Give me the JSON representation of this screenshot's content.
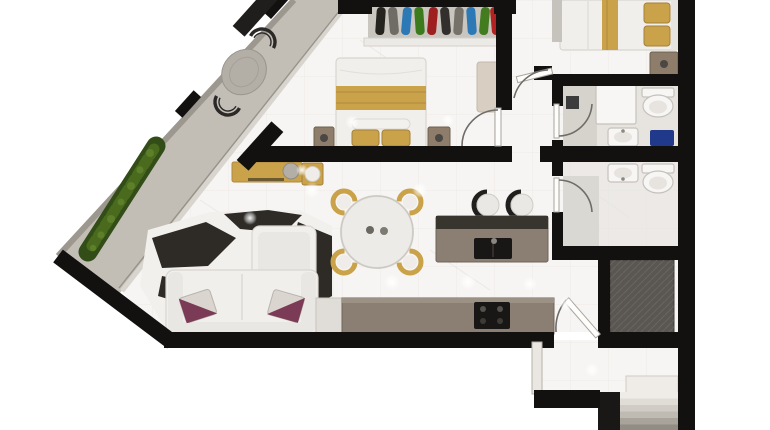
{
  "scene": {
    "type": "3d-rendered-apartment-floor-plan-top-view",
    "rooms": [
      {
        "name": "balcony-terrace"
      },
      {
        "name": "master-bedroom"
      },
      {
        "name": "second-bedroom"
      },
      {
        "name": "bathroom-top"
      },
      {
        "name": "bathroom-bottom"
      },
      {
        "name": "hallway"
      },
      {
        "name": "living-room"
      },
      {
        "name": "dining-area"
      },
      {
        "name": "kitchen"
      },
      {
        "name": "entry-vestibule"
      },
      {
        "name": "stair-lobby"
      },
      {
        "name": "elevator-shaft"
      }
    ],
    "furniture_icons": [
      "balcony-round-table-icon",
      "balcony-wire-chair-icon",
      "planter-hedge-icon",
      "open-wardrobe-icon",
      "double-bed-icon",
      "nightstand-icon",
      "bedroom-bench-icon",
      "gold-console-icon",
      "round-wall-mirror-icon",
      "dining-table-icon",
      "gold-dining-chair-icon",
      "kitchen-island-icon",
      "bar-stool-icon",
      "kitchen-counter-icon",
      "cooktop-icon",
      "fridge-icon",
      "l-shaped-sofa-icon",
      "cowhide-rug-icon",
      "throw-pillow-icon",
      "toilet-icon",
      "sink-icon",
      "shower-drain-icon",
      "blue-mat-icon",
      "stairs-icon"
    ]
  },
  "palette": {
    "wall": "#121110",
    "wall-light": "#c6c2bc",
    "marble": "#f7f5f3",
    "tile-line": "#e3e0da",
    "balcony-a": "#c2beb6",
    "balcony-b": "#aba69d",
    "slab-edge": "#9d988f",
    "glass": "#d8d5cf",
    "glass-dark": "#97928a",
    "planter-dark": "#324d17",
    "planter-mid": "#4a6b1d",
    "planter-light": "#5d7f2a",
    "gold": "#c9a24a",
    "gold-dark": "#b08a3e",
    "wood": "#8d7d6a",
    "counter": "#8a7f72",
    "counter-dark": "#38342e",
    "black-appliance": "#191715",
    "white-furn": "#f1efec",
    "furn-line": "#d9d5d0",
    "furn-shade": "#e9e7e3",
    "pillow-purple": "#7b3a55",
    "pillow-light": "#dad5cf",
    "rug-dark": "#2e2a26",
    "rug-light": "#f2f0ed",
    "bath-tile": "#e7e4df",
    "shower-tile": "#d6d3cd",
    "drain": "#3c3c3c",
    "blue": "#20398a",
    "elevator": "#5a5753",
    "elevator-line": "#6e6a64",
    "door-arc": "#6f6c67",
    "bench": "#d8cfc2",
    "fixture": "#f7f6f4",
    "fixture-line": "#c5c2bc",
    "lamp": "#4a4744",
    "table-gray": "#b3aea6",
    "chair-wire": "#2b2927",
    "clothes": [
      "#26241f",
      "#6f6c65",
      "#2c79b5",
      "#3c7a1e",
      "#9e1f1f",
      "#332f2c",
      "#76726a",
      "#2c79b5",
      "#437c1f",
      "#b32222"
    ],
    "stairs": [
      "#efece8",
      "#e0dcd6",
      "#d0ccc5",
      "#bfbab2",
      "#a8a39b",
      "#918c84"
    ]
  }
}
